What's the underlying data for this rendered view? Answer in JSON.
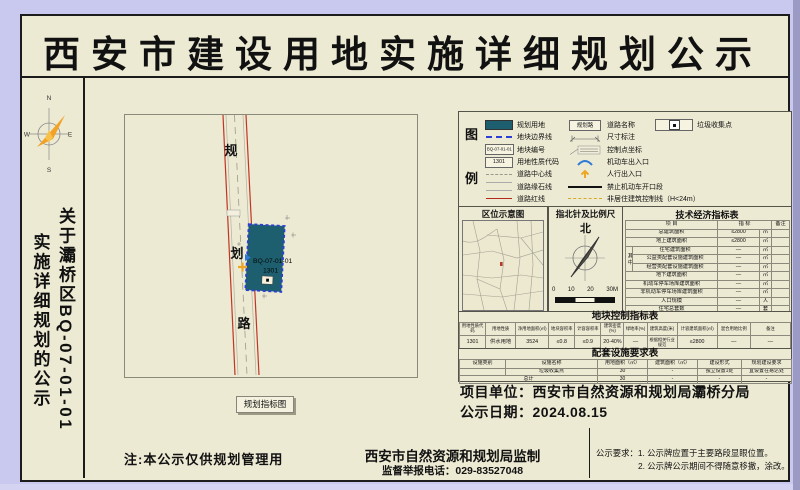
{
  "page": {
    "title": "西安市建设用地实施详细规划公示",
    "side_note_line1": "关于灞桥区BQ-07-01-01",
    "side_note_line2": "实施详细规划的公示",
    "compass": {
      "n": "N",
      "e": "E",
      "s": "S",
      "w": "W"
    }
  },
  "map": {
    "caption": "规划指标图",
    "road_chars": [
      "规",
      "划",
      "路"
    ],
    "plot": {
      "code": "BQ-07-01-01",
      "use_code": "1301"
    }
  },
  "legend": {
    "char1": "图",
    "char2": "例",
    "items_col1": [
      {
        "name": "planned-land",
        "label": "规划用地"
      },
      {
        "name": "plot-boundary",
        "label": "地块边界线"
      },
      {
        "name": "plot-code",
        "label": "地块编号",
        "text": "BQ-07-01-01"
      },
      {
        "name": "use-code",
        "label": "用地性质代码",
        "text": "1301"
      },
      {
        "name": "road-centerline",
        "label": "道路中心线"
      },
      {
        "name": "road-curb",
        "label": "道路缘石线"
      },
      {
        "name": "road-redline",
        "label": "道路红线"
      }
    ],
    "items_col2": [
      {
        "name": "road-name",
        "label": "道路名称",
        "text": "规划路"
      },
      {
        "name": "dimension",
        "label": "尺寸标注"
      },
      {
        "name": "control-point",
        "label": "控制点坐标"
      },
      {
        "name": "vehicle-entrance",
        "label": "机动车出入口"
      },
      {
        "name": "pedestrian-entrance",
        "label": "人行出入口"
      },
      {
        "name": "no-vehicle-opening",
        "label": "禁止机动车开口段"
      },
      {
        "name": "non-residential-line",
        "label": "非居住建筑控制线（H<24m）"
      }
    ],
    "items_col3": [
      {
        "name": "garbage-point",
        "label": "垃圾收集点"
      }
    ]
  },
  "location_panel": {
    "title": "区位示意图"
  },
  "north_panel": {
    "title": "指北针及比例尺",
    "north": "北",
    "ticks": [
      "0",
      "10",
      "20",
      "30M"
    ]
  },
  "tech_table": {
    "title": "技术经济指标表",
    "col_item": "项  目",
    "col_value": "指  标",
    "col_note": "备注",
    "group_label": "其中",
    "rows": [
      {
        "item": "总建筑面积",
        "value": "≤2800",
        "unit": "㎡",
        "note": ""
      },
      {
        "item": "地上建筑面积",
        "value": "≤2800",
        "unit": "㎡",
        "note": ""
      },
      {
        "item": "住宅建筑面积",
        "value": "—",
        "unit": "㎡",
        "note": ""
      },
      {
        "item": "公益类配套设施建筑面积",
        "value": "—",
        "unit": "㎡",
        "note": ""
      },
      {
        "item": "经营类配套设施建筑面积",
        "value": "—",
        "unit": "㎡",
        "note": ""
      },
      {
        "item": "地下建筑面积",
        "value": "—",
        "unit": "㎡",
        "note": ""
      },
      {
        "item": "机动车停车场库建筑面积",
        "value": "—",
        "unit": "㎡",
        "note": ""
      },
      {
        "item": "非机动车停车场库建筑面积",
        "value": "—",
        "unit": "㎡",
        "note": ""
      },
      {
        "item": "人口规模",
        "value": "—",
        "unit": "人",
        "note": ""
      },
      {
        "item": "住宅总套数",
        "value": "—",
        "unit": "套",
        "note": ""
      },
      {
        "item": "人均住宅建筑面积",
        "value": "—",
        "unit": "㎡",
        "note": ""
      }
    ]
  },
  "control_table": {
    "title": "地块控制指标表",
    "headers": [
      "用地性质代码",
      "用地性质",
      "净用地面积(㎡)",
      "地块容积率",
      "计容容积率",
      "建筑密度(%)",
      "绿地率(%)",
      "建筑高度(米)",
      "计容建筑面积(㎡)",
      "混合用地比例",
      "备注"
    ],
    "row": [
      "1301",
      "供水用地",
      "3524",
      "≤0.8",
      "≤0.9",
      "20-40%",
      "—",
      "根据相关行业规范",
      "≤2800",
      "—",
      "—"
    ]
  },
  "facility_table": {
    "title": "配套设施要求表",
    "headers": [
      "设施类别",
      "设施名称",
      "用地面积（㎡）",
      "建筑面积（㎡）",
      "建设形式",
      "规划建设要求"
    ],
    "row1": [
      "",
      "垃圾收集点",
      "30",
      "-",
      "独立设置1处",
      "宜设置在易达处"
    ],
    "row2_label": "总计",
    "row2": [
      "30",
      "-",
      "-",
      "-"
    ]
  },
  "footer": {
    "project_unit": "项目单位：西安市自然资源和规划局灞桥分局",
    "public_date": "公示日期：2024.08.15",
    "note": "注:本公示仅供规划管理用",
    "producer": "西安市自然资源和规划局监制",
    "hotline": "监督举报电话：029-83527048",
    "req_line1": "公示要求：1. 公示牌应置于主要路段显眼位置。",
    "req_line2": "2. 公示牌公示期间不得随意移撤，涂改。"
  },
  "colors": {
    "background": "#c9c9ef",
    "paper": "#edead3",
    "plot_fill": "#1d5f6e",
    "plot_boundary": "#2b3fd6",
    "road_redline": "#b5281e",
    "accent_orange": "#eca825"
  }
}
